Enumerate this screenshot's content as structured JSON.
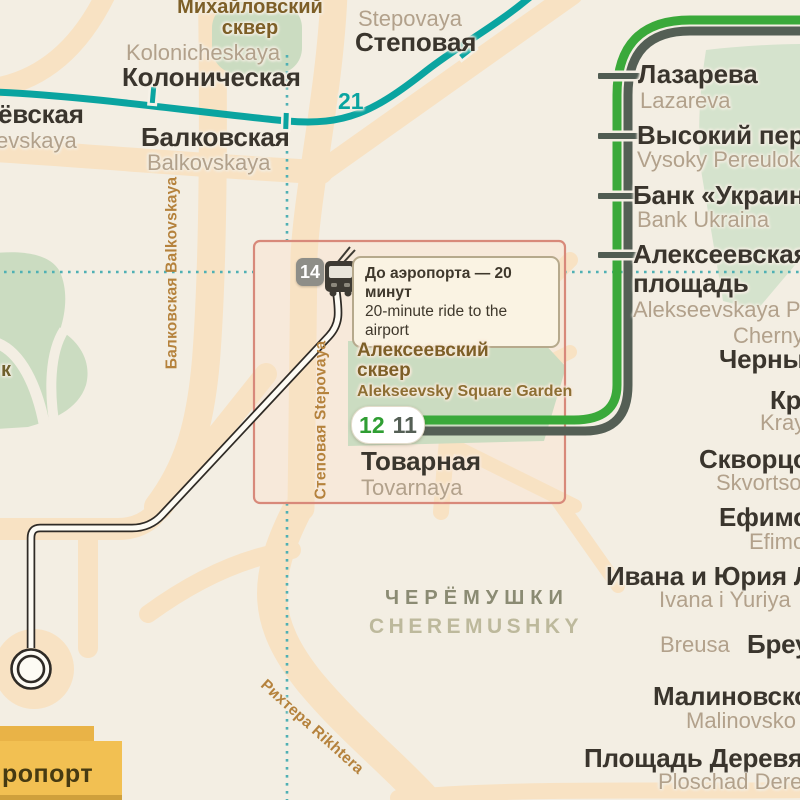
{
  "canvas": {
    "bg": "#f3eee3",
    "road": "#f8e2c3",
    "park": "#cbdcc1",
    "park_light": "#d5e3cd",
    "boundary_dots": "#4fb0b4",
    "text_main": "#3a352d",
    "text_translit": "#b2a18b",
    "street_label": "#b5823c",
    "park_label": "#7d5f27"
  },
  "lines": {
    "teal": {
      "number": "21",
      "color": "#0aa4a0"
    },
    "green": {
      "number": "12",
      "color": "#3aa93a"
    },
    "dark": {
      "number": "11",
      "color": "#545f55"
    },
    "trolleybus": {
      "number": "14",
      "badge_bg": "#8e8e88"
    }
  },
  "teal_stations": [
    {
      "name": "ёвская",
      "translit": "evskaya"
    },
    {
      "name": "Колоническая",
      "translit": "Kolonicheskaya"
    },
    {
      "name": "Балковская",
      "translit": "Balkovskaya"
    },
    {
      "name": "Степовая",
      "translit": "Stepovaya"
    }
  ],
  "green_stations": [
    {
      "name": "Лазарева",
      "translit": "Lazareva"
    },
    {
      "name": "Высокий пере",
      "translit": "Vysoky Pereulok"
    },
    {
      "name": "Банк «Украина",
      "translit": "Bank Ukraina"
    },
    {
      "name": "Алексеевская площадь",
      "translit": "Alekseevskaya Pl"
    }
  ],
  "edge_stations": [
    {
      "name": "Черны",
      "translit": "Cherny"
    },
    {
      "name": "Кр",
      "translit": "Kray"
    },
    {
      "name": "Скворцо",
      "translit": "Skvortso"
    },
    {
      "name": "Ефимо",
      "translit": "Efimo"
    },
    {
      "name": "Ивана и Юрия Л",
      "translit": "Ivana i Yuriya"
    },
    {
      "name": "Бреу",
      "translit": "Breusa"
    },
    {
      "name": "Малиновско",
      "translit": "Malinovsko"
    },
    {
      "name": "Площадь Деревян",
      "translit": "Ploschad Derevyan"
    }
  ],
  "callout": {
    "route_badge": "14",
    "tooltip": {
      "ru": "До аэропорта — 20 минут",
      "en": "20-minute ride to the airport"
    },
    "park": {
      "lines": [
        "Алексеевский",
        "сквер"
      ],
      "en": "Alekseevsky Square Garden"
    },
    "badges": {
      "green": "12",
      "dark": "11"
    },
    "station": {
      "name": "Товарная",
      "translit": "Tovarnaya"
    }
  },
  "parks": {
    "mikhailovsky": {
      "lines": [
        "Михайловский",
        "сквер"
      ]
    },
    "west_fragment": "к"
  },
  "district": {
    "ru": "ЧЕРЁМУШКИ",
    "en": "CHEREMUSHKY"
  },
  "streets": {
    "balkovskaya": {
      "ru": "Балковская",
      "en": "Balkovskaya"
    },
    "stepovaya": {
      "ru": "Степовая",
      "en": "Stepovaya"
    },
    "rikhtera": {
      "ru": "Рихтера",
      "en": "Rikhtera"
    }
  },
  "airport": {
    "label_fragment": "ропорт"
  }
}
